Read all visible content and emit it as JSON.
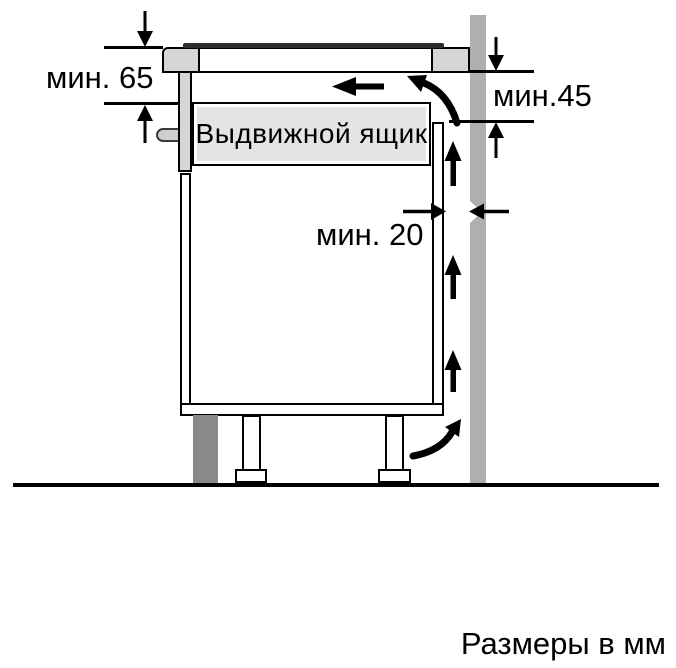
{
  "diagram": {
    "dimensions": {
      "top_left": "мин. 65",
      "top_right": "мин.45",
      "gap": "мин. 20"
    },
    "drawer_label": "Выдвижной ящик",
    "footer": "Размеры в мм",
    "colors": {
      "wall": "#afafaf",
      "plinth": "#8a8a8a",
      "counter_block": "#d6d6d6",
      "drawer_fill": "#e4e4e4",
      "glass": "#2e2e2e",
      "line": "#000000"
    }
  }
}
